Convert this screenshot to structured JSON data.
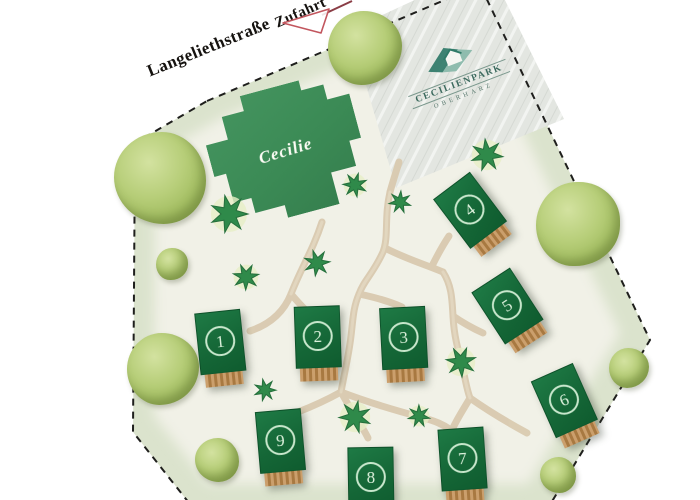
{
  "streets": {
    "main": "Langeliethstraße",
    "access": "Zufahrt"
  },
  "logo": {
    "title": "CECILIENPARK",
    "subtitle": "OBERHARZ"
  },
  "central_building": {
    "label": "Cecilie"
  },
  "houses": [
    {
      "label": "1"
    },
    {
      "label": "2"
    },
    {
      "label": "3"
    },
    {
      "label": "4"
    },
    {
      "label": "5"
    },
    {
      "label": "6"
    },
    {
      "label": "7"
    },
    {
      "label": "8"
    },
    {
      "label": "9"
    }
  ],
  "colors": {
    "house_green": "#156737",
    "central_green": "#3b8a55",
    "terrace_brown": "#a87941",
    "path_beige": "#d9cab0",
    "lawn_inner": "#f1f1e7",
    "lawn_edge": "#dbe3cd",
    "paved_area": "#e3e6e1",
    "boundary_dash": "#1f1f1d",
    "arrow_red": "#c2565e",
    "logo_teal": "#2f7a68",
    "tree_light_green": "#b7ce79",
    "shrub_dark_green": "#2f8a4a"
  }
}
